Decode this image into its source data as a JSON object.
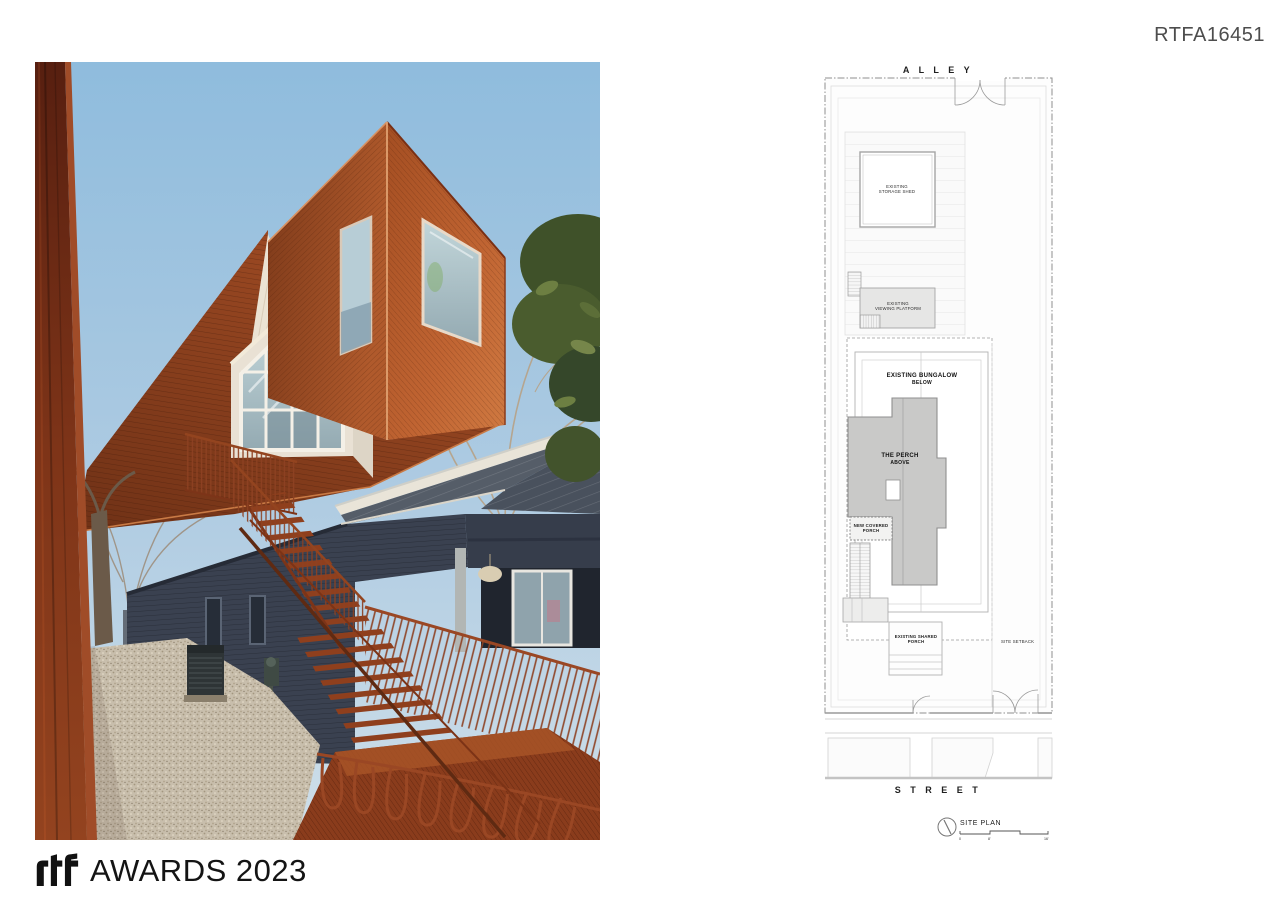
{
  "board": {
    "id": "RTFA16451"
  },
  "footer": {
    "logo_name": "rtf-logo",
    "award_text": "AWARDS 2023"
  },
  "site_plan": {
    "alley_label": "A L L E Y",
    "street_label": "S T R E E T",
    "shed_label_1": "EXISTING",
    "shed_label_2": "STORAGE SHED",
    "platform_label_1": "EXISTING",
    "platform_label_2": "VIEWING PLATFORM",
    "bungalow_label_1": "EXISTING BUNGALOW",
    "bungalow_label_2": "BELOW",
    "perch_label_1": "THE PERCH",
    "perch_label_2": "ABOVE",
    "covered_porch_label_1": "NEW COVERED",
    "covered_porch_label_2": "PORCH",
    "shared_porch_label_1": "EXISTING SHARED",
    "shared_porch_label_2": "PORCH",
    "setback_label": "SITE SETBACK",
    "title": "SITE PLAN",
    "scale_ticks": [
      "0",
      "8'",
      "16'"
    ]
  },
  "colors": {
    "sky_top": "#8fbcdd",
    "sky_bottom": "#cfdfe9",
    "cedar": "#b4582a",
    "corten": "#7e3418",
    "rust_steel": "#94431e",
    "bungalow_navy": "#3a4150",
    "roof_gray": "#4d5561",
    "gravel": "#c8beac",
    "plan_fill_gray": "#c9c9c8",
    "plan_line_gray": "#9a9a9a"
  }
}
